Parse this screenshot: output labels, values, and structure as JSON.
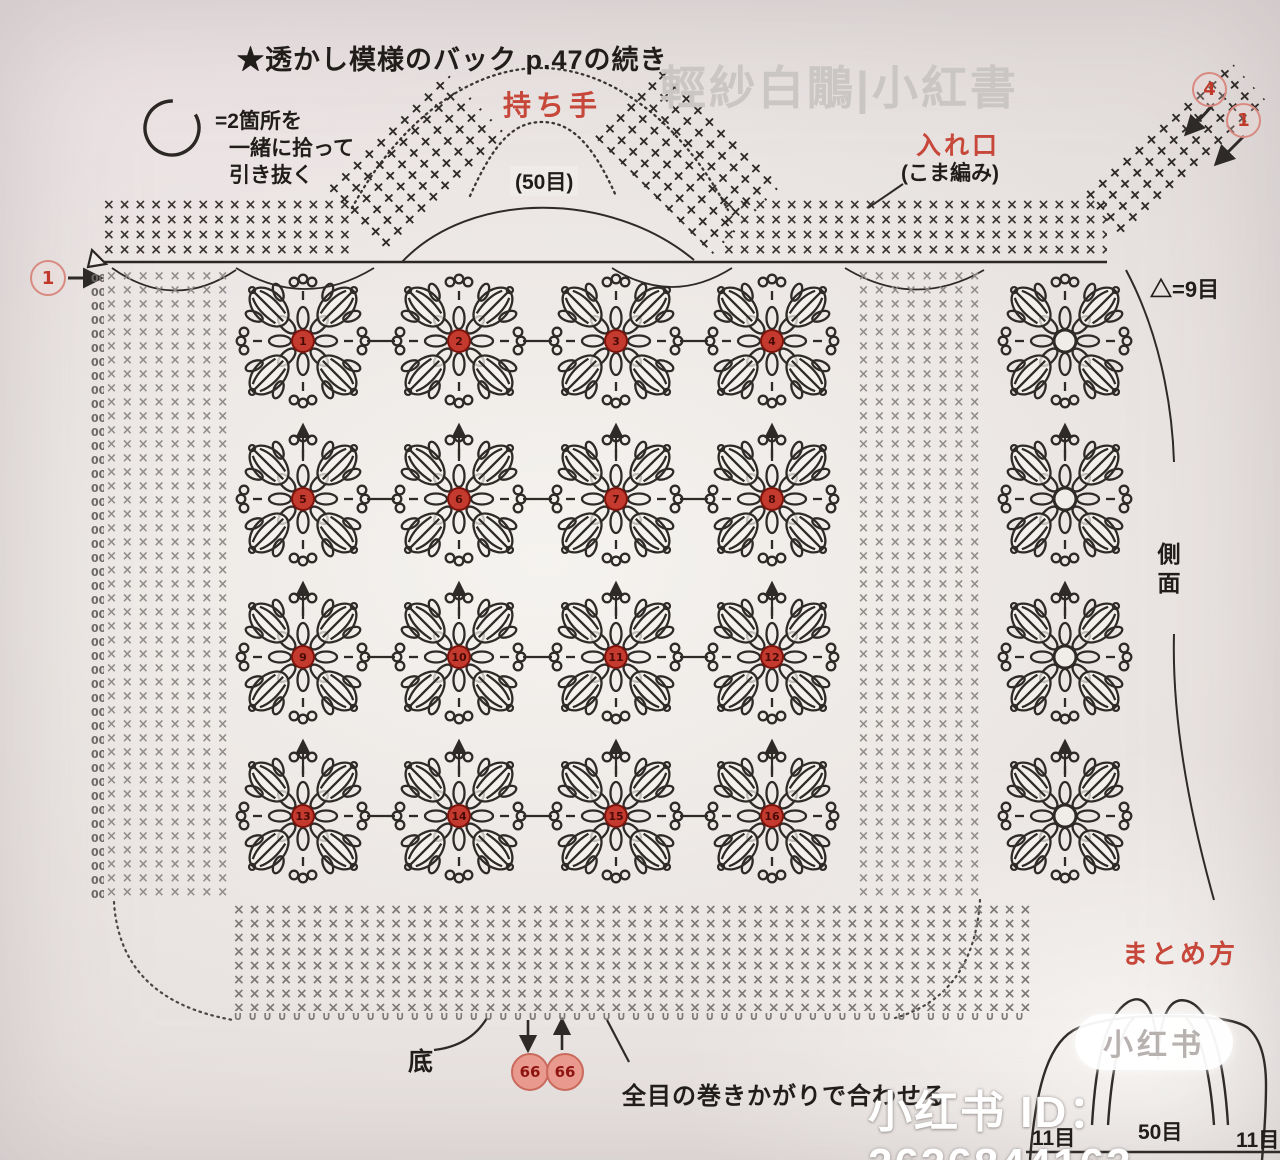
{
  "header": {
    "title": "★透かし模様のバック p.47の続き",
    "watermark": "輕紗白鷳|小紅書"
  },
  "legend": {
    "lines": [
      "=2箇所を",
      "一緒に拾って",
      "引き抜く"
    ]
  },
  "labels": {
    "handle": "持ち手",
    "handle_count": "(50目)",
    "entrance": "入れ口",
    "entrance_sub": "(こま編み)",
    "triangle_eq": "△=9目",
    "side": "側面",
    "bottom": "底",
    "matome": "まとめ方",
    "seam_note": "全目の巻きかがりで合わせる",
    "width_left": "11目",
    "width_center": "50目",
    "width_right": "11目"
  },
  "circled_numbers": {
    "left_start": "1",
    "top_right_a": "4",
    "top_right_b": "1",
    "seam_a": "66",
    "seam_b": "66"
  },
  "watermark_bottom": {
    "pill": "小红书",
    "id_text": "小红书 ID：2636844163"
  },
  "colors": {
    "stitch_dark": "#2e2a27",
    "stitch_gray": "#8f8c89",
    "accent_red": "#c7473a",
    "motif_center_fill": "#c43a2e",
    "motif_center_edge": "#7c140d",
    "circled_red": "#c0392b",
    "paper": "#efece8"
  },
  "motif_grid": {
    "cols": [
      303,
      459,
      616,
      772
    ],
    "rows": [
      341,
      499,
      657,
      816
    ],
    "side_col": 1065,
    "numbers": [
      1,
      2,
      3,
      4,
      5,
      6,
      7,
      8,
      9,
      10,
      11,
      12,
      13,
      14,
      15,
      16
    ],
    "side_count": 4
  },
  "pattern_areas": [
    {
      "name": "top-band-left-mesh",
      "x": 103,
      "y": 198,
      "w": 250,
      "h": 62,
      "glyph": "×",
      "color": "#3a3532",
      "size": 14,
      "ls": 4,
      "lh": 15,
      "rot": 0
    },
    {
      "name": "top-band-right-mesh",
      "x": 723,
      "y": 198,
      "w": 384,
      "h": 62,
      "glyph": "×",
      "color": "#3a3532",
      "size": 14,
      "ls": 4,
      "lh": 15,
      "rot": 0
    },
    {
      "name": "left-panel-mesh",
      "x": 106,
      "y": 270,
      "w": 124,
      "h": 630,
      "glyph": "×",
      "color": "#8f8c89",
      "size": 13,
      "ls": 5,
      "lh": 14,
      "rot": 0
    },
    {
      "name": "left-chain-column",
      "x": 91,
      "y": 272,
      "w": 13,
      "h": 628,
      "glyph": "0",
      "color": "#6b6865",
      "size": 11,
      "ls": 0,
      "lh": 14,
      "rot": 0
    },
    {
      "name": "middle-strip-mesh",
      "x": 858,
      "y": 270,
      "w": 128,
      "h": 634,
      "glyph": "×",
      "color": "#8f8c89",
      "size": 13,
      "ls": 5,
      "lh": 14,
      "rot": 0
    },
    {
      "name": "bottom-band-mesh",
      "x": 233,
      "y": 903,
      "w": 798,
      "h": 108,
      "glyph": "×",
      "color": "#7b7875",
      "size": 14,
      "ls": 4,
      "lh": 14,
      "rot": 0
    },
    {
      "name": "bottom-band-scallop",
      "x": 233,
      "y": 1008,
      "w": 798,
      "h": 16,
      "glyph": "∪",
      "color": "#7b7875",
      "size": 12,
      "ls": 5,
      "lh": 16,
      "rot": 0
    },
    {
      "name": "handle-plus-band-left",
      "x": 332,
      "y": 116,
      "w": 168,
      "h": 92,
      "glyph": "+",
      "color": "#2e2a27",
      "size": 16,
      "ls": 3,
      "lh": 15,
      "rot": -44
    },
    {
      "name": "handle-plus-band-right",
      "x": 604,
      "y": 110,
      "w": 168,
      "h": 100,
      "glyph": "+",
      "color": "#2e2a27",
      "size": 16,
      "ls": 3,
      "lh": 15,
      "rot": 45
    },
    {
      "name": "top-right-plus-strip",
      "x": 1076,
      "y": 118,
      "w": 200,
      "h": 64,
      "glyph": "+",
      "color": "#2e2a27",
      "size": 16,
      "ls": 3,
      "lh": 15,
      "rot": -42
    }
  ]
}
